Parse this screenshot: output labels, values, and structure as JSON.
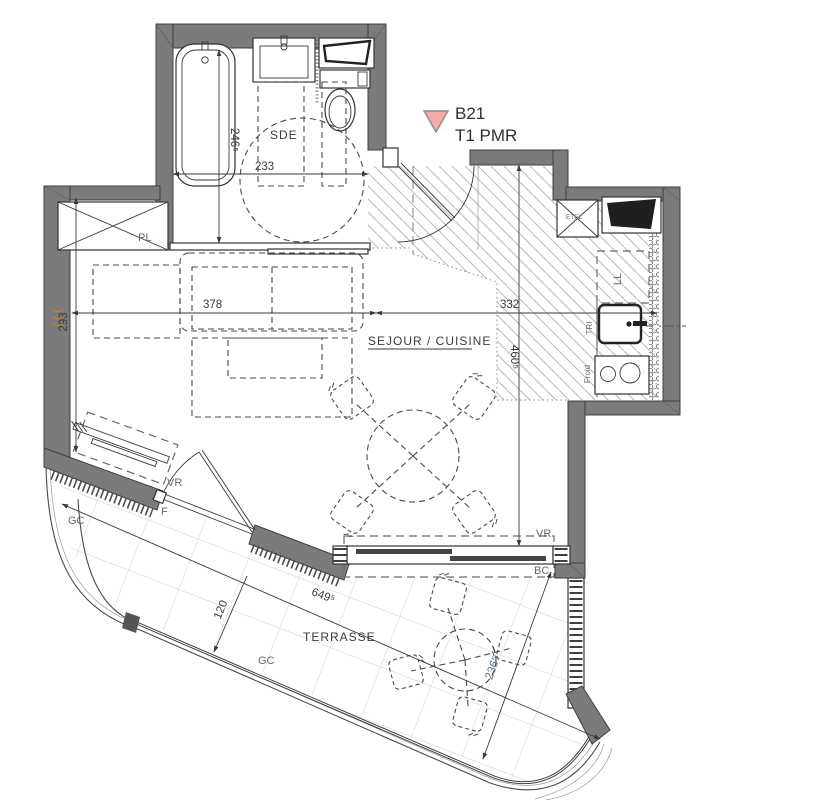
{
  "unit": {
    "id": "B21",
    "type": "T1 PMR"
  },
  "rooms": {
    "bathroom": "SDE",
    "living": "SEJOUR / CUISINE",
    "terrace": "TERRASSE"
  },
  "labels": {
    "closet": "PL",
    "utility": "ETEL",
    "washer": "LL",
    "tri": "TRI",
    "fridge": "Froid",
    "shutter_west": "VR",
    "french_window": "F",
    "railing_west": "GC",
    "railing_south": "GC",
    "shutter_south": "VR",
    "bay": "BC"
  },
  "dims": {
    "bath_w": "233",
    "bath_d": "246⁵",
    "liv_w1": "378",
    "liv_w2": "332",
    "liv_d1": "293",
    "liv_d2": "460⁵",
    "ter_len": "649⁵",
    "ter_w1": "120",
    "ter_w2": "236⁵"
  },
  "colors": {
    "wall": "#7b7b7b",
    "outline": "#3f3f3f",
    "label": "#5d6b7a",
    "dim_text": "#3a3a3a",
    "dim_accent": "#5a7090",
    "hatch": "#b9b9b9",
    "tile": "#cdcdcd",
    "marker_fill": "#f5a9a9",
    "marker_stroke": "#8a8a8a",
    "squiggle": "#d2801e"
  }
}
